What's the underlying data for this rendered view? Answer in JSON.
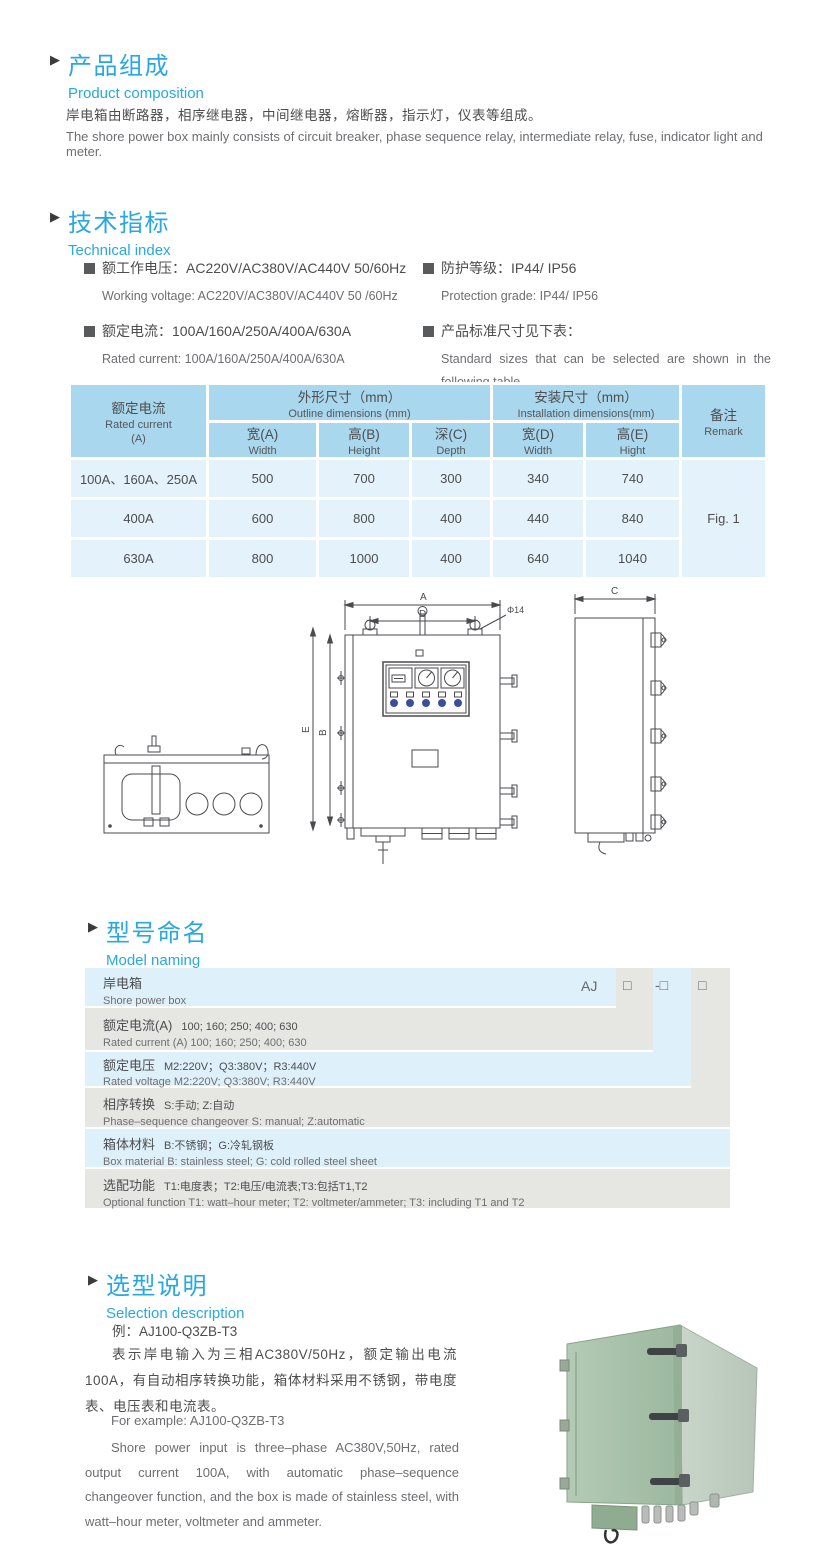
{
  "colors": {
    "accent_blue": "#29a8e0",
    "table_header_bg": "#a9d7ed",
    "table_cell_bg": "#e3f2fb",
    "model_row_blue": "#def0fa",
    "model_row_gray": "#e6e6e3",
    "text_dark": "#4d4d4f",
    "text_gray": "#6d6e71",
    "box_green": "#a6c0a8"
  },
  "product_composition": {
    "title_zh": "产品组成",
    "title_en": "Product  composition",
    "body_zh": "岸电箱由断路器，相序继电器，中间继电器，熔断器，指示灯，仪表等组成。",
    "body_en": "The shore power box mainly consists of circuit breaker, phase sequence relay, intermediate relay, fuse, indicator light and meter."
  },
  "technical_index": {
    "title_zh": "技术指标",
    "title_en": "Technical index",
    "specs": [
      {
        "zh": "额工作电压：AC220V/AC380V/AC440V  50/60Hz",
        "en": "Working voltage: AC220V/AC380V/AC440V 50 /60Hz"
      },
      {
        "zh": "额定电流：100A/160A/250A/400A/630A",
        "en": "Rated current: 100A/160A/250A/400A/630A"
      },
      {
        "zh": "防护等级：IP44/ IP56",
        "en": "Protection grade: IP44/ IP56"
      },
      {
        "zh": "产品标准尺寸见下表：",
        "en": "Standard sizes that can be selected are shown in the following table"
      }
    ]
  },
  "size_table": {
    "col_current_zh": "额定电流",
    "col_current_en": "Rated current",
    "col_current_unit": "(A)",
    "group_outline_zh": "外形尺寸（mm）",
    "group_outline_en": "Outline dimensions (mm)",
    "group_install_zh": "安装尺寸（mm）",
    "group_install_en": "Installation dimensions(mm)",
    "remark_zh": "备注",
    "remark_en": "Remark",
    "sub": [
      {
        "zh": "宽(A)",
        "en": "Width"
      },
      {
        "zh": "高(B)",
        "en": "Height"
      },
      {
        "zh": "深(C)",
        "en": "Depth"
      },
      {
        "zh": "宽(D)",
        "en": "Width"
      },
      {
        "zh": "高(E)",
        "en": "Hight"
      }
    ],
    "rows": [
      [
        "100A、160A、250A",
        "500",
        "700",
        "300",
        "340",
        "740"
      ],
      [
        "400A",
        "600",
        "800",
        "400",
        "440",
        "840"
      ],
      [
        "630A",
        "800",
        "1000",
        "400",
        "640",
        "1040"
      ]
    ],
    "remark_value": "Fig. 1"
  },
  "drawing": {
    "labels": {
      "a": "A",
      "d": "D",
      "dia": "Φ14",
      "e": "E",
      "b": "B",
      "c": "C"
    }
  },
  "model_naming": {
    "title_zh": "型号命名",
    "title_en": "Model naming",
    "codes": [
      "AJ",
      "□",
      "-□",
      "□"
    ],
    "rows": [
      {
        "zh": "岸电箱",
        "opts": "",
        "en": "Shore power box"
      },
      {
        "zh": "额定电流(A)",
        "opts": "100; 160; 250; 400; 630",
        "en": "Rated current (A) 100; 160; 250; 400; 630"
      },
      {
        "zh": "额定电压",
        "opts": "M2:220V；Q3:380V；R3:440V",
        "en": "Rated voltage  M2:220V;  Q3:380V;  R3:440V"
      },
      {
        "zh": "相序转换",
        "opts": "S:手动; Z:自动",
        "en": "Phase–sequence changeover  S: manual;  Z:automatic"
      },
      {
        "zh": "箱体材料",
        "opts": "B:不锈钢；G:冷轧钢板",
        "en": "Box material   B: stainless steel; G: cold rolled steel sheet"
      },
      {
        "zh": "选配功能",
        "opts": "T1:电度表；T2:电压/电流表;T3:包括T1,T2",
        "en": "Optional function  T1: watt–hour meter; T2: voltmeter/ammeter; T3: including T1 and T2"
      }
    ]
  },
  "selection": {
    "title_zh": "选型说明",
    "title_en": "Selection description",
    "example_zh": "例：AJ100-Q3ZB-T3",
    "body_zh": "表示岸电输入为三相AC380V/50Hz，额定输出电流100A，有自动相序转换功能，箱体材料采用不锈钢，带电度表、电压表和电流表。",
    "example_en": "For example: AJ100-Q3ZB-T3",
    "body_en": "Shore power input is three–phase AC380V,50Hz, rated output current 100A, with automatic phase–sequence changeover function, and the box is made of stainless steel, with watt–hour meter, voltmeter and ammeter."
  }
}
